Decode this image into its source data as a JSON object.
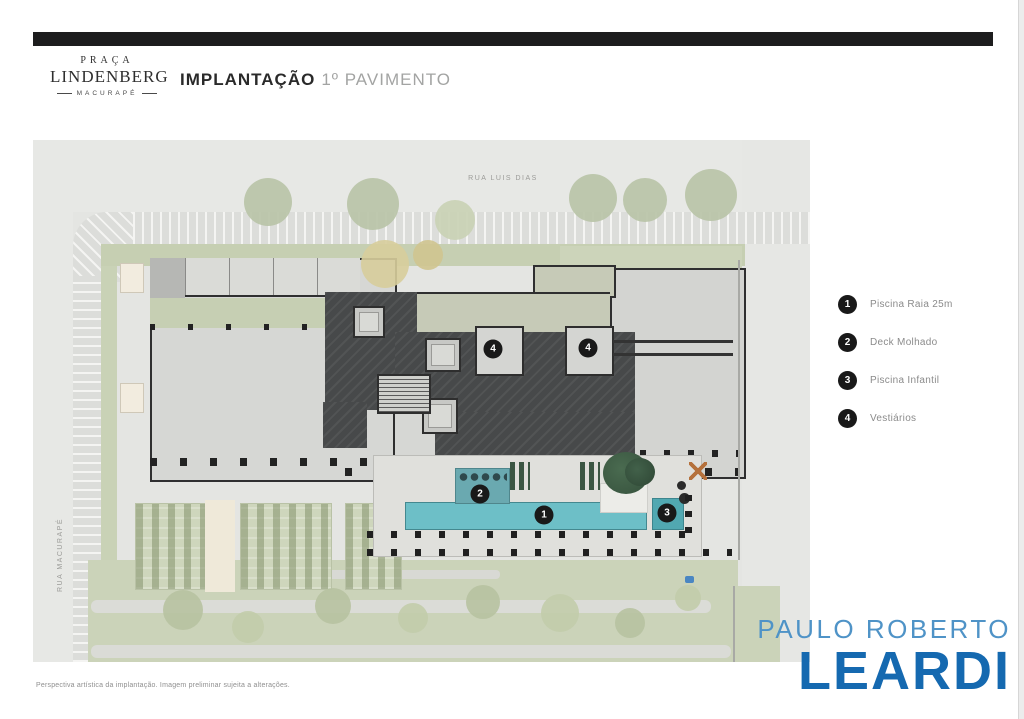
{
  "header": {
    "logo": {
      "line1": "PRAÇA",
      "line2": "LINDENBERG",
      "line3": "MACURAPÉ"
    },
    "title_bold": "IMPLANTAÇÃO",
    "title_light": "1º PAVIMENTO"
  },
  "plan": {
    "street_top": "RUA LUIS DIAS",
    "street_left": "RUA MACURAPÉ",
    "markers": {
      "pool": "1",
      "deck": "2",
      "infantil": "3",
      "vest": "4"
    }
  },
  "legend": {
    "items": [
      {
        "number": "1",
        "label": "Piscina Raia 25m"
      },
      {
        "number": "2",
        "label": "Deck Molhado"
      },
      {
        "number": "3",
        "label": "Piscina Infantil"
      },
      {
        "number": "4",
        "label": "Vestiários"
      }
    ]
  },
  "footer": {
    "disclaimer": "Perspectiva artística da implantação. Imagem preliminar sujeita a alterações.",
    "brand_top": "PAULO ROBERTO",
    "brand_bottom": "LEARDI"
  },
  "colors": {
    "bar_black": "#1d1d1e",
    "pool_teal": "#6dbfc7",
    "charcoal_roof": "#47494a",
    "sage_green": "#c6cfb2",
    "brand_blue_light": "#4f93c7",
    "brand_blue_dark": "#1569b0",
    "marker_black": "#191919"
  }
}
